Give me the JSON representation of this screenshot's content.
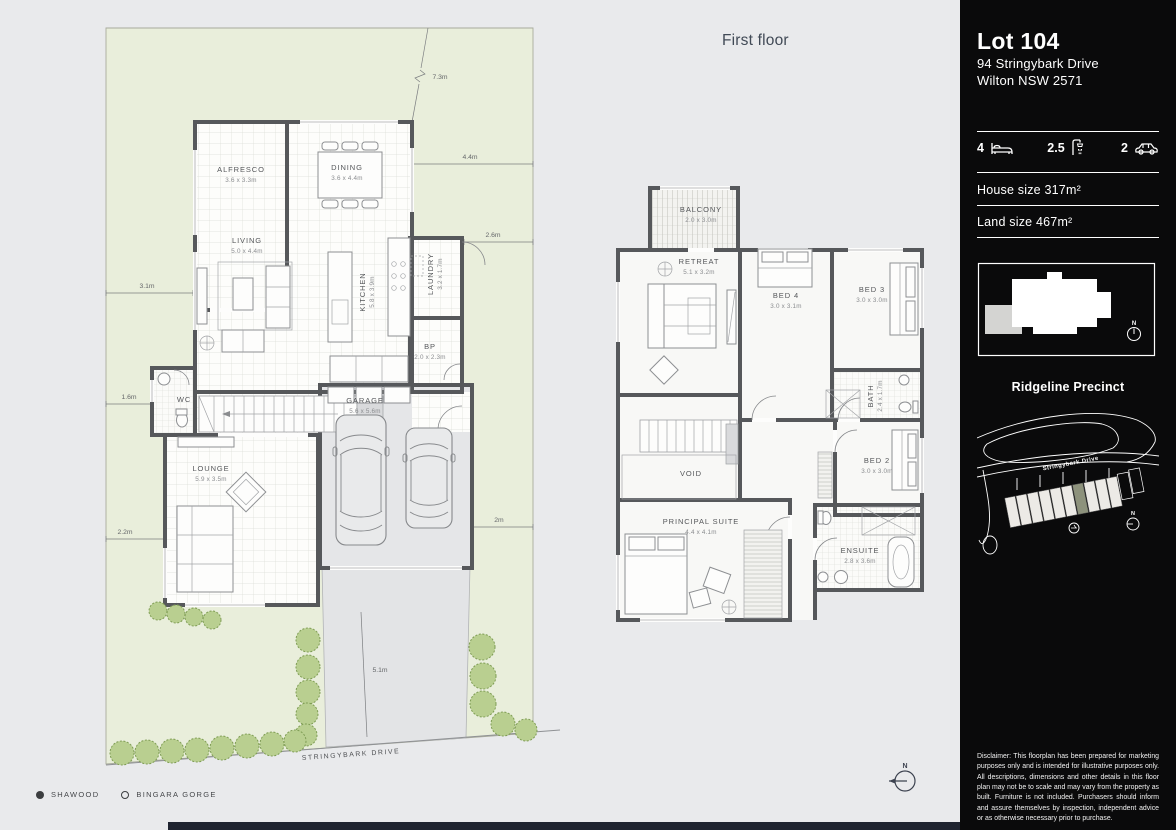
{
  "colors": {
    "page_bg": "#e9eaec",
    "site_green": "#e9eedb",
    "wall": "#56585b",
    "tree": "#b9cf90",
    "sidebar_bg": "#0a0a0b",
    "highlight_lot": "#8d927c",
    "bottom_bar": "#1f2430"
  },
  "compass": {
    "n": "N"
  },
  "ground_floor": {
    "street_label": "STRINGYBARK DRIVE",
    "rooms": [
      {
        "name": "ALFRESCO",
        "dims": "3.6 x 3.3m"
      },
      {
        "name": "DINING",
        "dims": "3.6 x 4.4m"
      },
      {
        "name": "LIVING",
        "dims": "5.0 x 4.4m"
      },
      {
        "name": "KITCHEN",
        "dims": "5.8 x 3.9m"
      },
      {
        "name": "LAUNDRY",
        "dims": "3.2 x 1.7m"
      },
      {
        "name": "BP",
        "dims": "2.0 x 2.3m"
      },
      {
        "name": "WC",
        "dims": ""
      },
      {
        "name": "LOUNGE",
        "dims": "5.9 x 3.5m"
      },
      {
        "name": "GARAGE",
        "dims": "5.6 x 5.6m"
      }
    ],
    "site_dims": {
      "top_boundary": "7.3m",
      "top_right": "4.4m",
      "right_upper": "2.6m",
      "left_upper": "3.1m",
      "left_mid": "1.6m",
      "left_lower": "2.2m",
      "right_lower": "2m",
      "driveway": "5.1m"
    }
  },
  "first_floor": {
    "title": "First floor",
    "rooms": [
      {
        "name": "BALCONY",
        "dims": "2.0 x 3.0m"
      },
      {
        "name": "RETREAT",
        "dims": "5.1 x 3.2m"
      },
      {
        "name": "BED 4",
        "dims": "3.0 x 3.1m"
      },
      {
        "name": "BED 3",
        "dims": "3.0 x 3.0m"
      },
      {
        "name": "BATH",
        "dims": "2.4 x 1.7m"
      },
      {
        "name": "BED 2",
        "dims": "3.0 x 3.0m"
      },
      {
        "name": "VOID",
        "dims": ""
      },
      {
        "name": "PRINCIPAL SUITE",
        "dims": "4.4 x 4.1m"
      },
      {
        "name": "ENSUITE",
        "dims": "2.8 x 3.6m"
      }
    ]
  },
  "legend": {
    "items": [
      {
        "label": "SHAWOOD"
      },
      {
        "label": "BINGARA GORGE"
      }
    ]
  },
  "sidebar": {
    "lot_title": "Lot 104",
    "address_line1": "94 Stringybark Drive",
    "address_line2": "Wilton NSW 2571",
    "stats": [
      {
        "value": "4",
        "icon": "bed-icon"
      },
      {
        "value": "2.5",
        "icon": "shower-icon"
      },
      {
        "value": "2",
        "icon": "car-icon"
      }
    ],
    "house_size": "House size 317m²",
    "land_size": "Land size 467m²",
    "precinct_title": "Ridgeline Precinct",
    "map_street_label": "Stringybark Drive",
    "disclaimer": "Disclaimer: This floorplan has been prepared for marketing purposes only and is intended for illustrative purposes only. All descriptions, dimensions and other details in this floor plan may not be to scale and may vary from the property as built. Furniture is not included. Purchasers should inform and assure themselves by inspection, independent advice or as otherwise necessary prior to purchase."
  }
}
